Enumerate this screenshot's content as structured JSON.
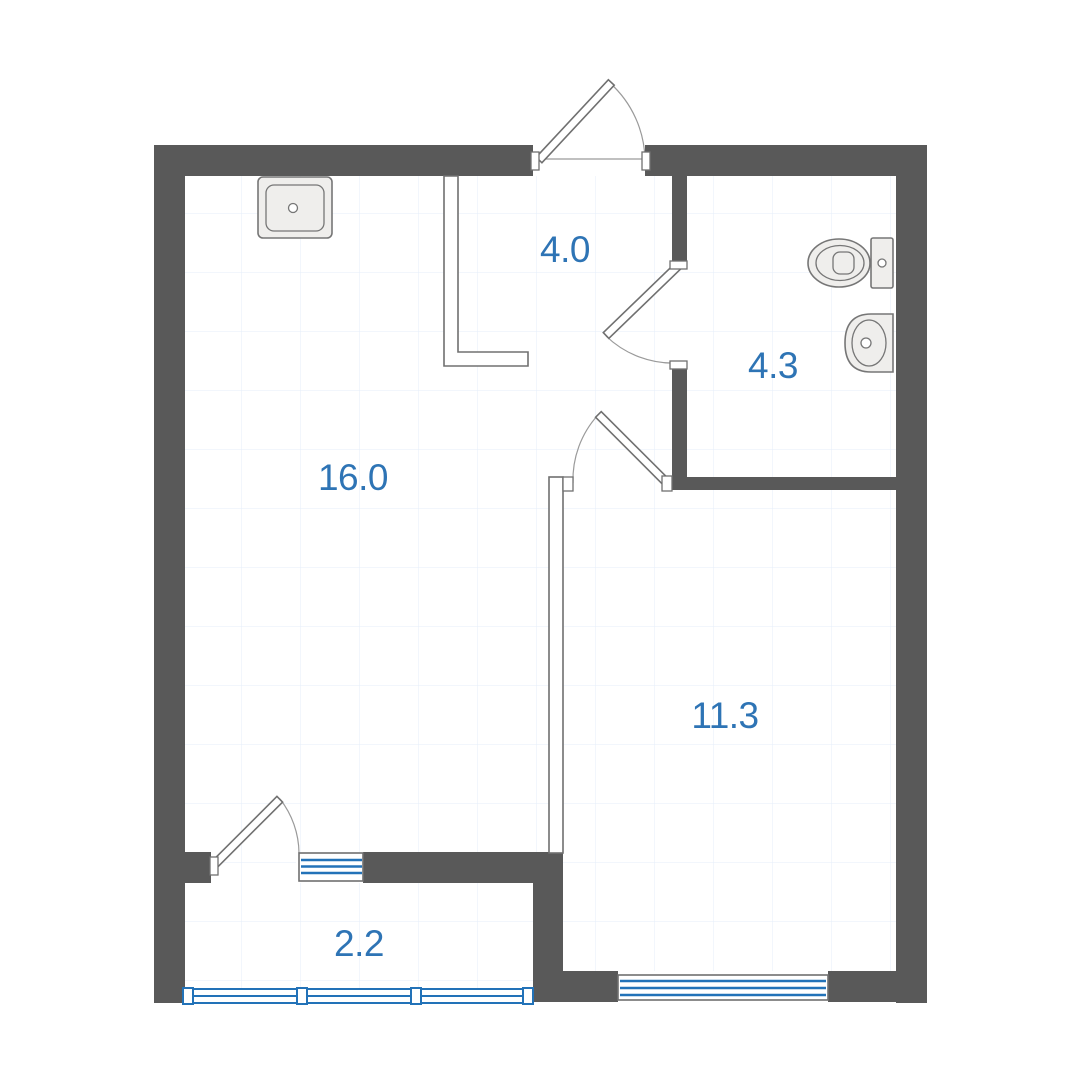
{
  "title": "One-room apartment floor plan",
  "colors": {
    "wall": "#595959",
    "floor": "#ffffff",
    "grid": "#e4eefa",
    "outline": "#707070",
    "arc": "#9a9a9a",
    "window": "#2272b8",
    "label": "#2e74b5",
    "fixture_fill": "#efeeec",
    "fixture_stroke": "#767676"
  },
  "rooms": [
    {
      "name": "living-kitchen",
      "area": "16.0"
    },
    {
      "name": "hallway",
      "area": "4.0"
    },
    {
      "name": "bathroom",
      "area": "4.3"
    },
    {
      "name": "room",
      "area": "11.3"
    },
    {
      "name": "balcony",
      "area": "2.2"
    }
  ],
  "doors": [
    "entrance-door",
    "bathroom-door",
    "room-door",
    "balcony-door"
  ],
  "windows": [
    "living-balcony-window",
    "room-window",
    "balcony-glazing"
  ],
  "fixtures": [
    "kitchen-sink",
    "toilet",
    "wash-basin"
  ]
}
